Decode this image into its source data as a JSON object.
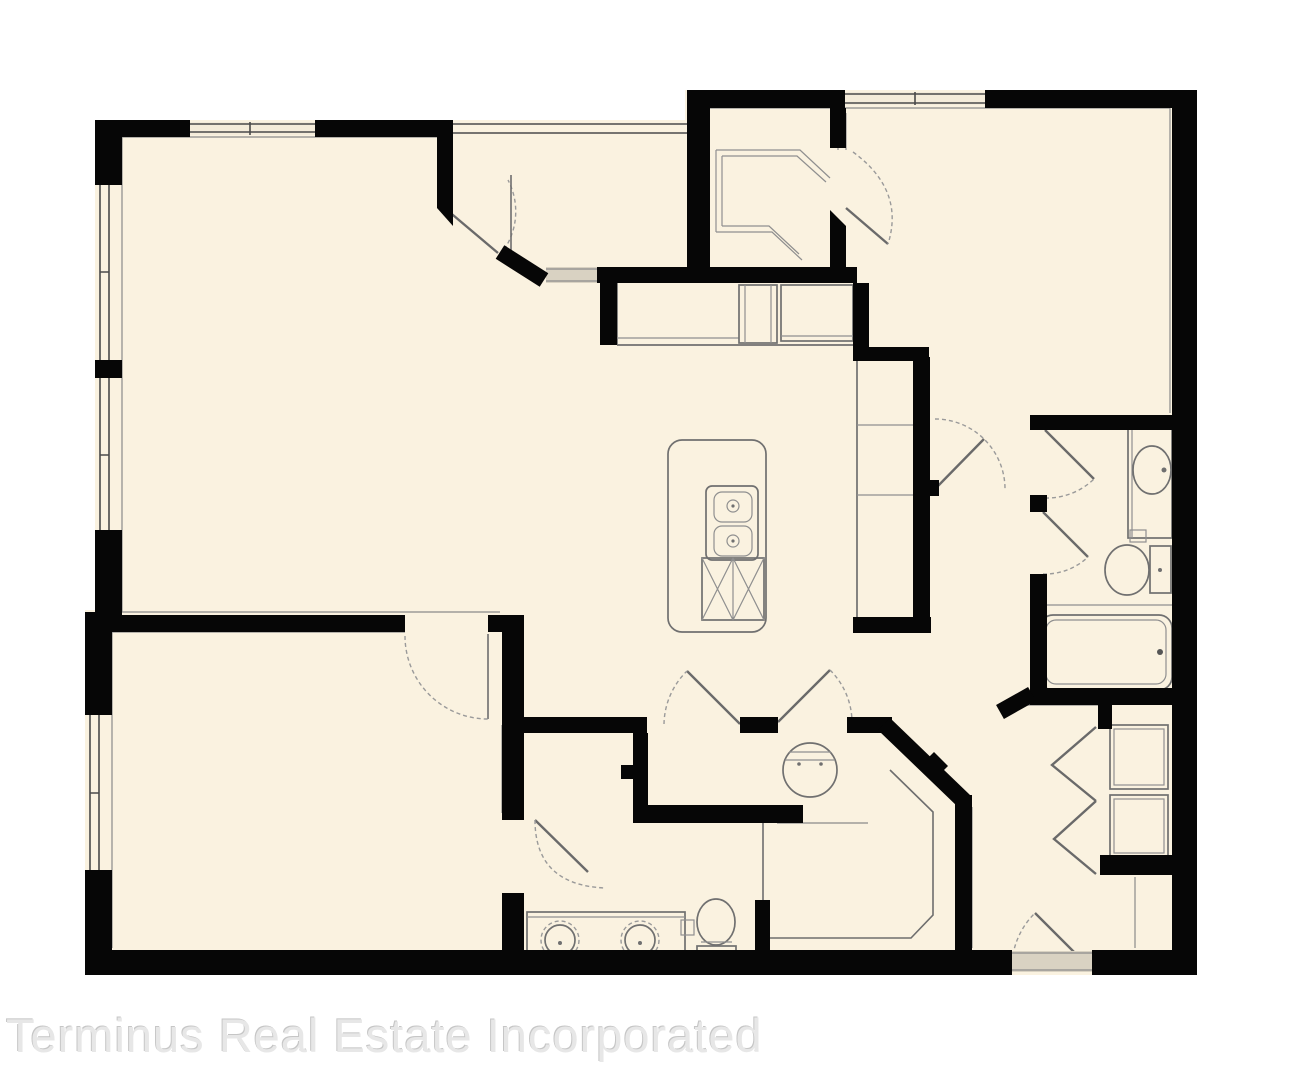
{
  "watermark": {
    "text": "Terminus Real Estate Incorporated"
  },
  "colors": {
    "background": "#ffffff",
    "floor": "#faf2e0",
    "wall": "#060606",
    "fixture_line": "#707070",
    "door_arc": "#9a9a9a",
    "opening_threshold": "#d9d2c2",
    "watermark_text": "#e7e7e7"
  },
  "fixtures": [
    "kitchen-island",
    "island-double-sink",
    "island-cabinet-x",
    "refrigerator",
    "range",
    "kitchen-counter",
    "walk-in-closet-shelves",
    "water-heater",
    "neo-angle-shower",
    "double-vanity-sinks",
    "toilet-master",
    "toilet-hall",
    "vanity-sink-hall",
    "bathtub",
    "linen-closet-shelves",
    "bifold-doors",
    "entry-door",
    "windows"
  ]
}
